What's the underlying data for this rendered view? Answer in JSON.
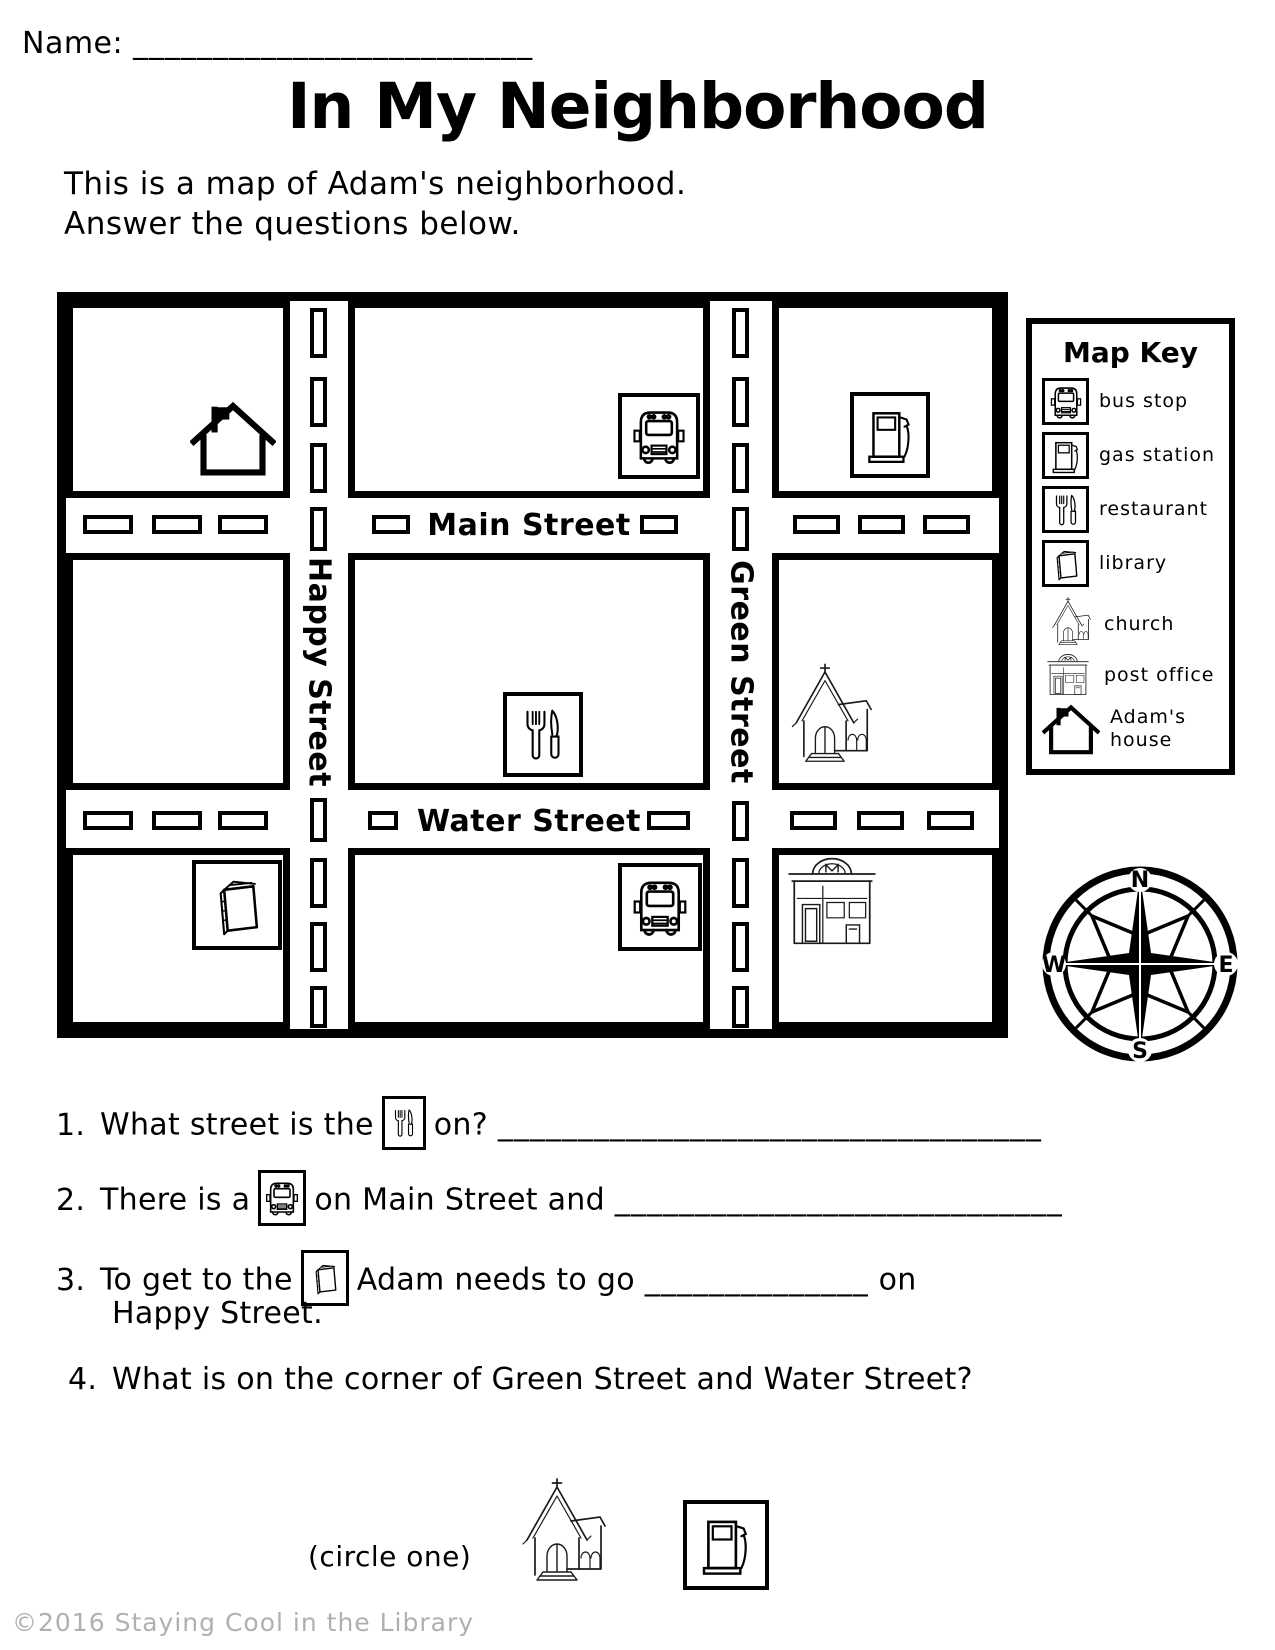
{
  "page": {
    "name_label": "Name:",
    "name_blank": "_________________________",
    "title": "In My Neighborhood",
    "intro1": "This is a map of Adam's neighborhood.",
    "intro2": "Answer the questions below.",
    "footer": "©2016 Staying Cool in the Library"
  },
  "map": {
    "main": "Main Street",
    "water": "Water Street",
    "happy": "Happy Street",
    "green": "Green Street",
    "placements": [
      {
        "block": "top-left",
        "icon": "house-icon",
        "meaning": "Adam's house"
      },
      {
        "block": "top-middle",
        "icon": "bus-icon",
        "meaning": "bus stop"
      },
      {
        "block": "top-right",
        "icon": "gas-station-icon",
        "meaning": "gas station"
      },
      {
        "block": "middle-center",
        "icon": "restaurant-icon",
        "meaning": "restaurant"
      },
      {
        "block": "middle-right",
        "icon": "church-icon",
        "meaning": "church"
      },
      {
        "block": "bottom-left",
        "icon": "library-icon",
        "meaning": "library"
      },
      {
        "block": "bottom-middle",
        "icon": "bus-icon",
        "meaning": "bus stop"
      },
      {
        "block": "bottom-right",
        "icon": "post-office-icon",
        "meaning": "post office"
      }
    ]
  },
  "key": {
    "title": "Map Key",
    "items": [
      {
        "icon": "bus-icon",
        "label": "bus stop"
      },
      {
        "icon": "gas-station-icon",
        "label": "gas station"
      },
      {
        "icon": "restaurant-icon",
        "label": "restaurant"
      },
      {
        "icon": "library-icon",
        "label": "library"
      },
      {
        "icon": "church-icon",
        "label": "church"
      },
      {
        "icon": "post-office-icon",
        "label": "post office"
      },
      {
        "icon": "house-icon",
        "label": "Adam's house"
      }
    ]
  },
  "compass": {
    "n": "N",
    "e": "E",
    "s": "S",
    "w": "W"
  },
  "q": [
    {
      "num": "1.",
      "pre": "What street is the",
      "icon": "restaurant-icon",
      "post": "on?",
      "blank": "__________________________________"
    },
    {
      "num": "2.",
      "pre": "There is a",
      "icon": "bus-icon",
      "post": "on Main Street and",
      "blank": "____________________________"
    },
    {
      "num": "3.",
      "pre": "To get to the",
      "icon": "library-icon",
      "mid": "Adam needs to go",
      "blank": "______________",
      "post": "on",
      "line2": "Happy Street."
    },
    {
      "num": "4.",
      "text": "What is on the corner of Green Street and Water Street?"
    }
  ],
  "circle": {
    "label": "(circle one)",
    "options": [
      "church-icon",
      "gas-station-icon"
    ]
  }
}
